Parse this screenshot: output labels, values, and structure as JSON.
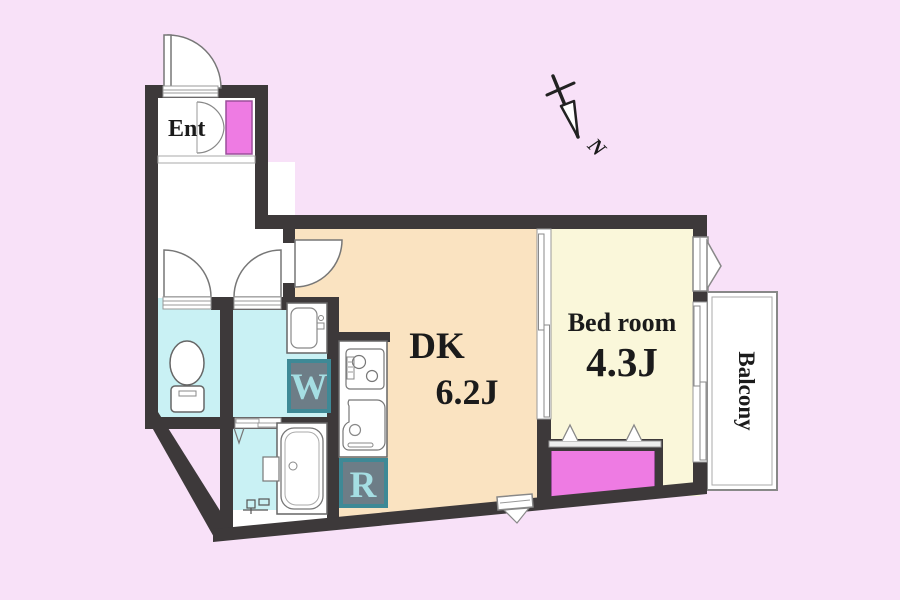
{
  "plan": {
    "rooms": {
      "entrance": {
        "label": "Ent"
      },
      "dining_kitchen": {
        "label": "DK",
        "area": "6.2J"
      },
      "bedroom": {
        "label": "Bed room",
        "area": "4.3J"
      },
      "balcony": {
        "label": "Balcony"
      }
    },
    "appliances": {
      "washing_machine": {
        "label": "W"
      },
      "refrigerator": {
        "label": "R"
      }
    },
    "compass": {
      "north_label": "N"
    }
  },
  "colors": {
    "background": "#F8E1F8",
    "wall": "#3D393A",
    "dk_floor": "#FAE3C1",
    "bedroom_floor": "#FAF7DA",
    "wet_room_floor": "#C9F1F4",
    "closet_magenta": "#EE7BE3",
    "appliance_box_fill": "#6D7D87",
    "appliance_box_border": "#3E8996",
    "appliance_letter": "#A5DEE3",
    "text": "#1B1B1B"
  }
}
